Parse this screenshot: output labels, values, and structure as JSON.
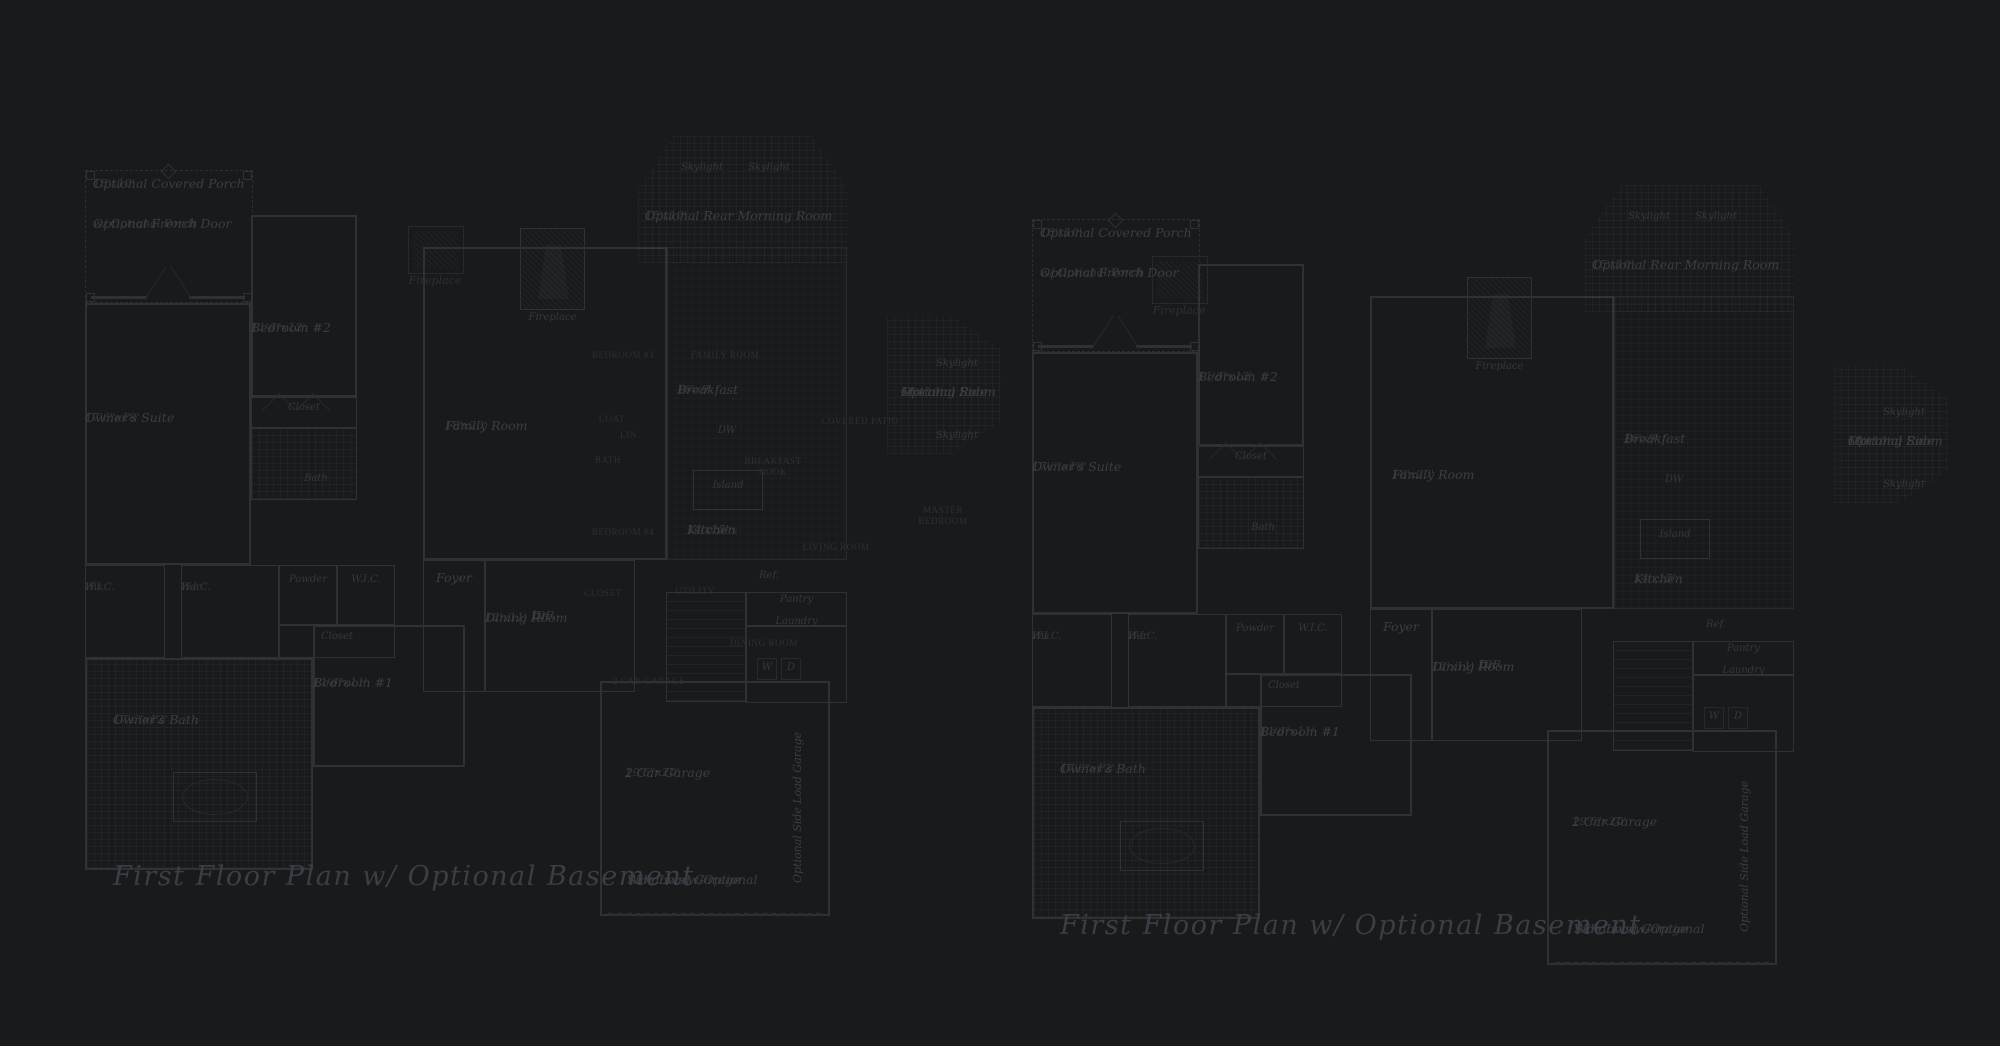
{
  "canvas": {
    "width": 2000,
    "height": 1046,
    "background": "#191a1b"
  },
  "colors": {
    "background": "#191a1b",
    "wall": "#2f3233",
    "wall_faint": "#27292b",
    "label_text": "#3b3e44",
    "underlay_text": "#2d3033",
    "caption_text": "#3b3e46"
  },
  "captions": {
    "left": "First Floor Plan  w/ Optional Basement",
    "right": "First Floor Plan  w/ Optional Basement"
  },
  "plan": {
    "porch": {
      "name": "Optional Covered Porch",
      "dims": "18'x10'",
      "door_line1": "Optional French Door",
      "door_line2": "w/ Optional Porch"
    },
    "owner_suite": {
      "name": "Owner's Suite",
      "dims": "17'6\"x18'"
    },
    "bedroom2": {
      "name": "Bedroom #2",
      "dims": "11'6\"x12'"
    },
    "closet_bedroom2": "Closet",
    "bath_bedroom2": "Bath",
    "fireplace": "Fireplace",
    "family_room": {
      "name": "Family Room",
      "dims": "18'x20'"
    },
    "rear_morning": {
      "skylight_left": "Skylight",
      "skylight_right": "Skylight",
      "name": "Optional Rear Morning Room",
      "dims": "15'x10'"
    },
    "side_morning": {
      "skylight_top": "Skylight",
      "name_line1": "Optional Side",
      "name_line2": "Morning Room",
      "dims": "15'x10'",
      "skylight_bottom": "Skylight"
    },
    "his_wic": {
      "line1": "His",
      "line2": "W.I.C."
    },
    "her_wic": {
      "line1": "Her",
      "line2": "W.I.C."
    },
    "powder": "Powder",
    "wic": "W.I.C.",
    "closet_hall": "Closet",
    "foyer": "Foyer",
    "owner_bath": {
      "name": "Owner's Bath",
      "dims": "17'6\"x12'"
    },
    "bedroom1": {
      "name": "Bedroom #1",
      "dims": "11'6\"x11'"
    },
    "stairs": {
      "line1": "Dn",
      "line2": "12R"
    },
    "breakfast": {
      "name": "Breakfast",
      "dims": "16'x9'"
    },
    "dw": "DW",
    "island": "Island",
    "kitchen": {
      "name": "Kitchen",
      "dims": "14'x15'"
    },
    "ref": "Ref.",
    "pantry": "Pantry",
    "laundry": "Laundry",
    "washer": "W",
    "dryer": "D",
    "dining": {
      "name": "Dining Room",
      "dims": "12'x11'"
    },
    "garage": {
      "name": "2 Car Garage",
      "dims": "19'6\"x20'"
    },
    "side_load": "Optional Side Load Garage",
    "windows_note": {
      "line1": "Windows w/Optional",
      "line2": "Side Load Garage"
    }
  },
  "underlay": {
    "fireplace": "Fireplace",
    "bedroom3": "BEDROOM #3",
    "family_room": "FAMILY ROOM",
    "coat": "COAT",
    "lin": "LIN.",
    "bath": "BATH",
    "breakfast_line1": "BREAKFAST",
    "breakfast_line2": "NOOK",
    "kitchen": "KITCHEN",
    "bedroom4": "BEDROOM #4",
    "closet": "CLOSET",
    "utility": "UTILITY",
    "dining_room": "DINING ROOM",
    "garage": "2 CAR GARAGE",
    "covered_patio": "COVERED PATIO",
    "living_room": "LIVING ROOM",
    "master_line1": "MASTER",
    "master_line2": "BEDROOM"
  }
}
